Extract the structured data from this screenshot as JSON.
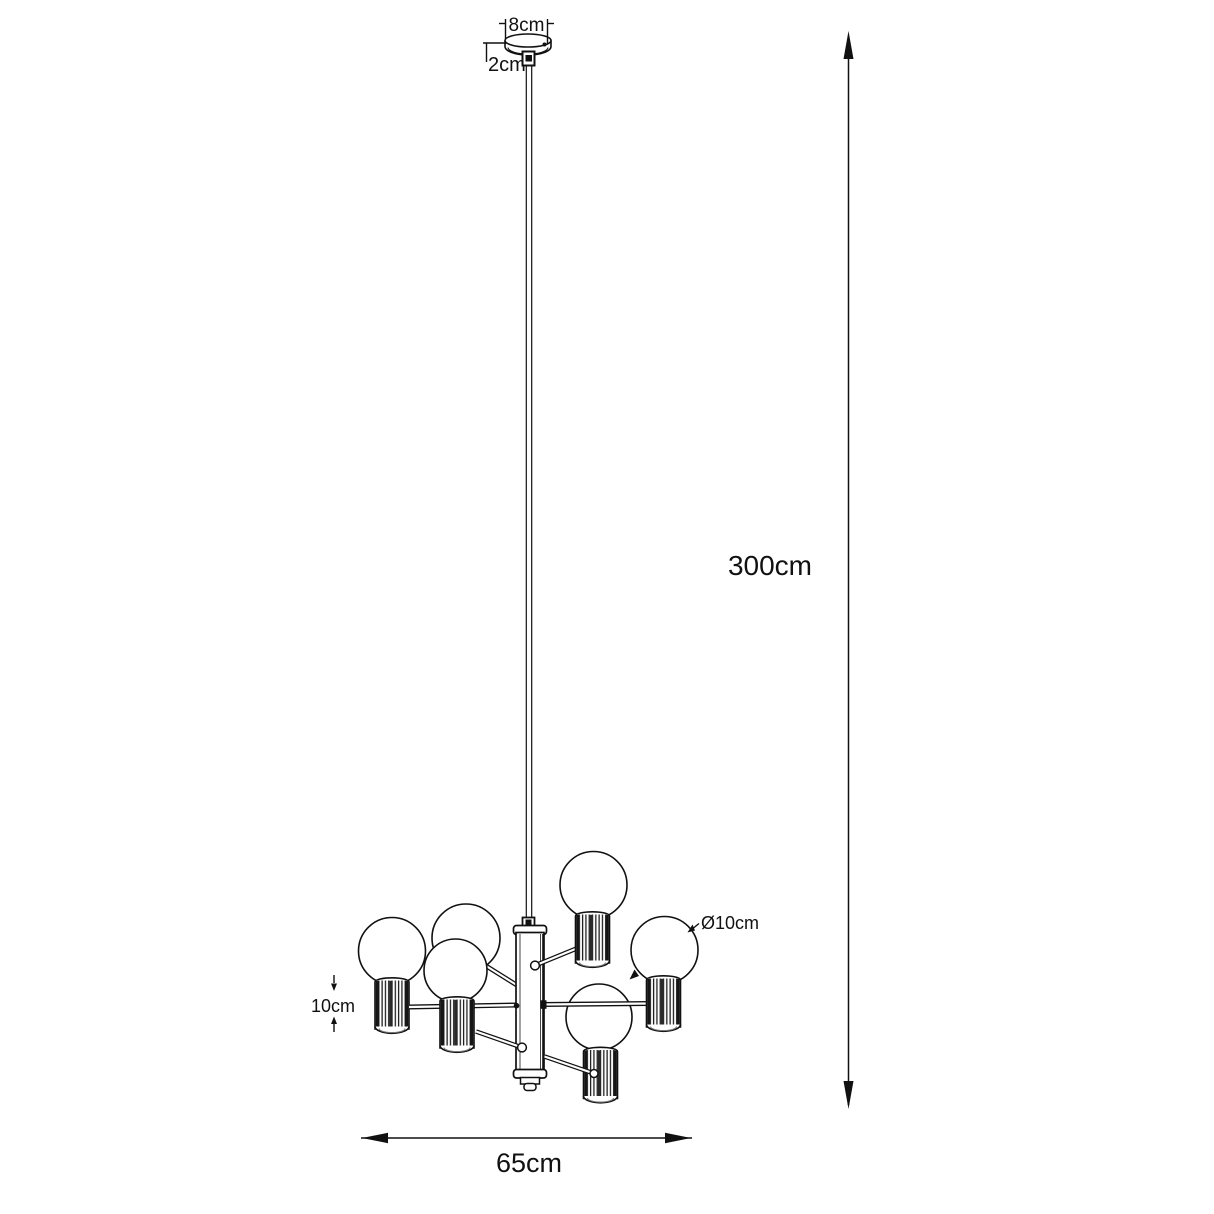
{
  "diagram": {
    "subject": "6-light chandelier technical dimension drawing",
    "background_color": "#ffffff",
    "line_color": "#111111",
    "bulb_count": 6,
    "labels": {
      "canopy_width": "8cm",
      "canopy_height": "2cm",
      "suspension_length": "300cm",
      "fixture_width": "65cm",
      "socket_height": "10cm",
      "bulb_diameter": "Ø10cm"
    }
  }
}
